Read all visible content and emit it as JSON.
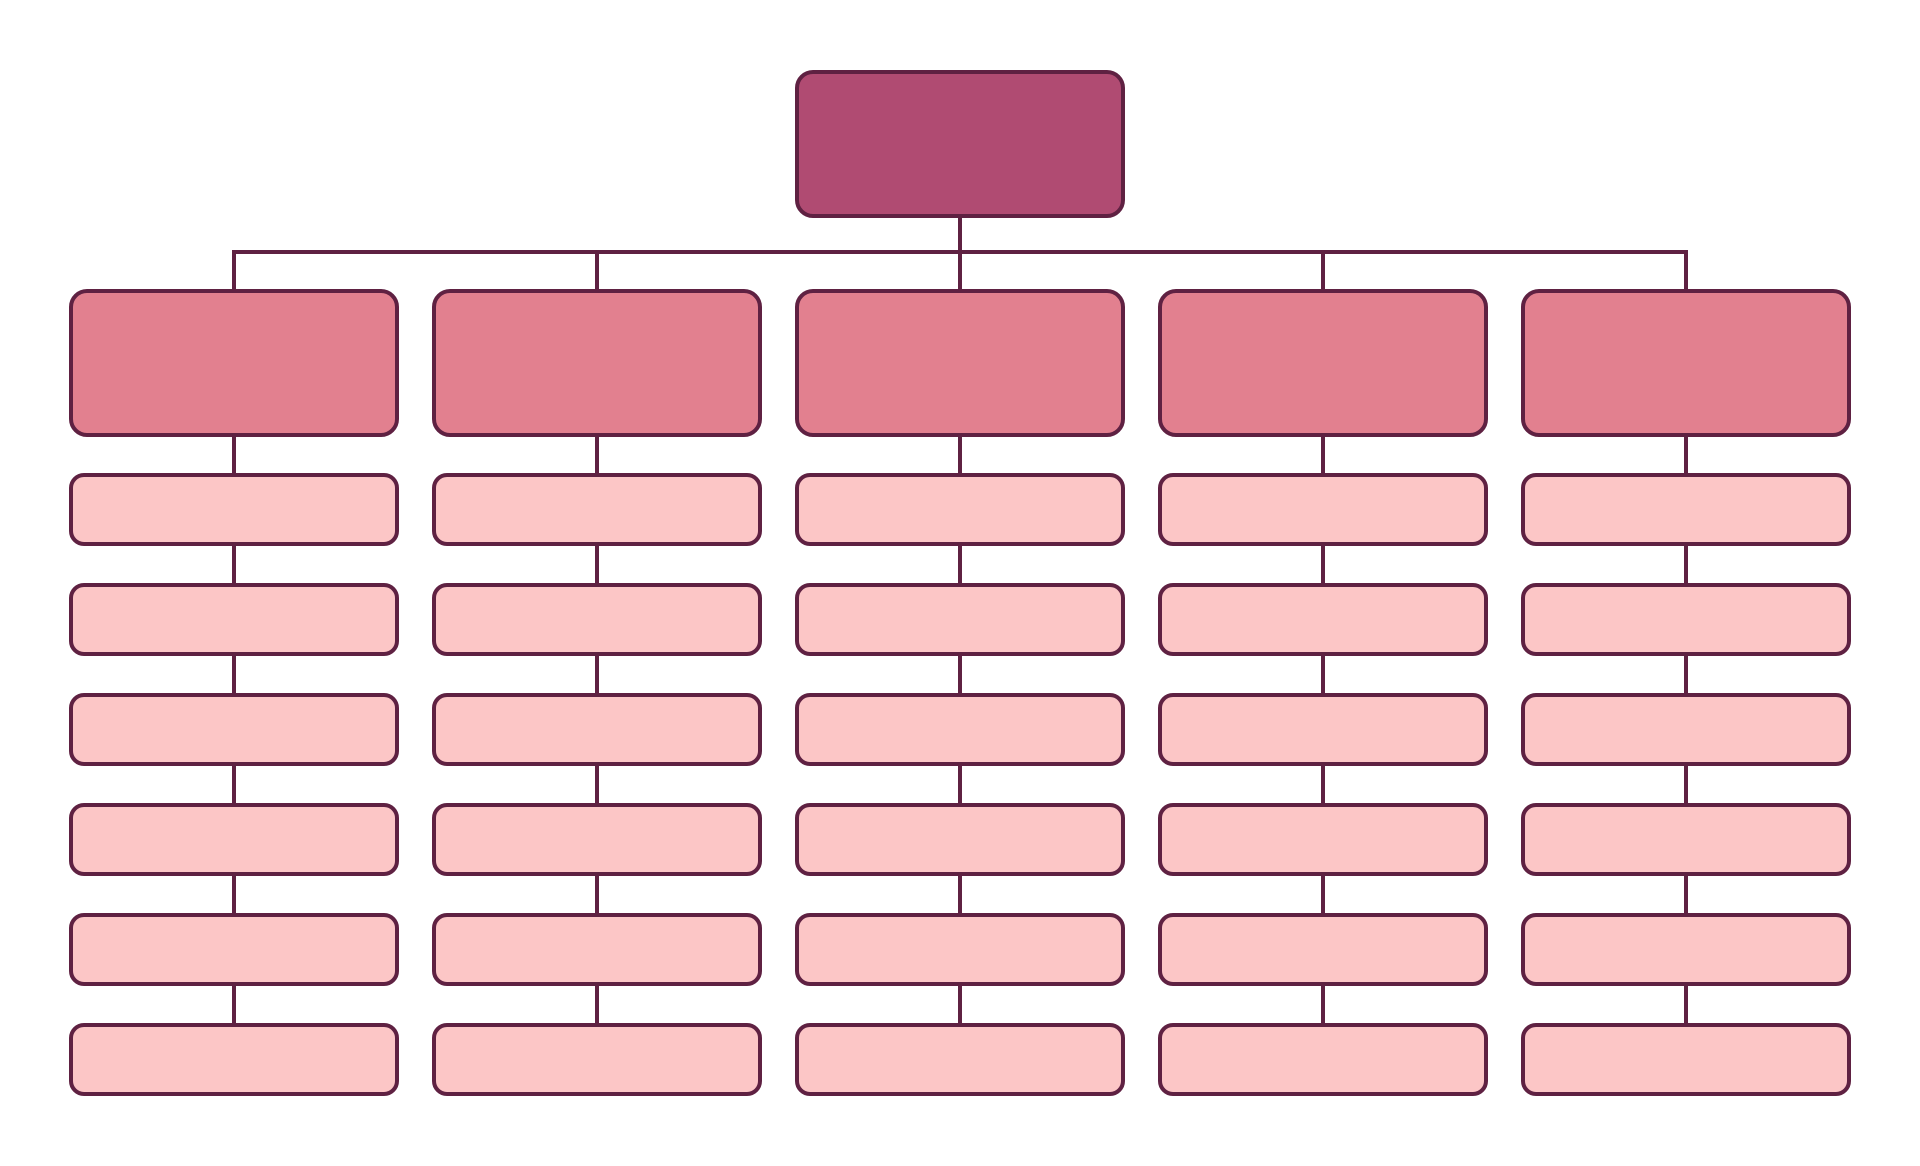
{
  "diagram": {
    "type": "org-chart-template",
    "background": "#ffffff",
    "palette": {
      "outline": "#5f2142",
      "root_fill": "#b04b72",
      "branch_fill": "#e2808f",
      "leaf_fill": "#fcc6c6"
    },
    "root": {
      "label": ""
    },
    "branches": [
      {
        "label": "",
        "children": [
          {
            "label": ""
          },
          {
            "label": ""
          },
          {
            "label": ""
          },
          {
            "label": ""
          },
          {
            "label": ""
          },
          {
            "label": ""
          }
        ]
      },
      {
        "label": "",
        "children": [
          {
            "label": ""
          },
          {
            "label": ""
          },
          {
            "label": ""
          },
          {
            "label": ""
          },
          {
            "label": ""
          },
          {
            "label": ""
          }
        ]
      },
      {
        "label": "",
        "children": [
          {
            "label": ""
          },
          {
            "label": ""
          },
          {
            "label": ""
          },
          {
            "label": ""
          },
          {
            "label": ""
          },
          {
            "label": ""
          }
        ]
      },
      {
        "label": "",
        "children": [
          {
            "label": ""
          },
          {
            "label": ""
          },
          {
            "label": ""
          },
          {
            "label": ""
          },
          {
            "label": ""
          },
          {
            "label": ""
          }
        ]
      },
      {
        "label": "",
        "children": [
          {
            "label": ""
          },
          {
            "label": ""
          },
          {
            "label": ""
          },
          {
            "label": ""
          },
          {
            "label": ""
          },
          {
            "label": ""
          }
        ]
      }
    ]
  }
}
